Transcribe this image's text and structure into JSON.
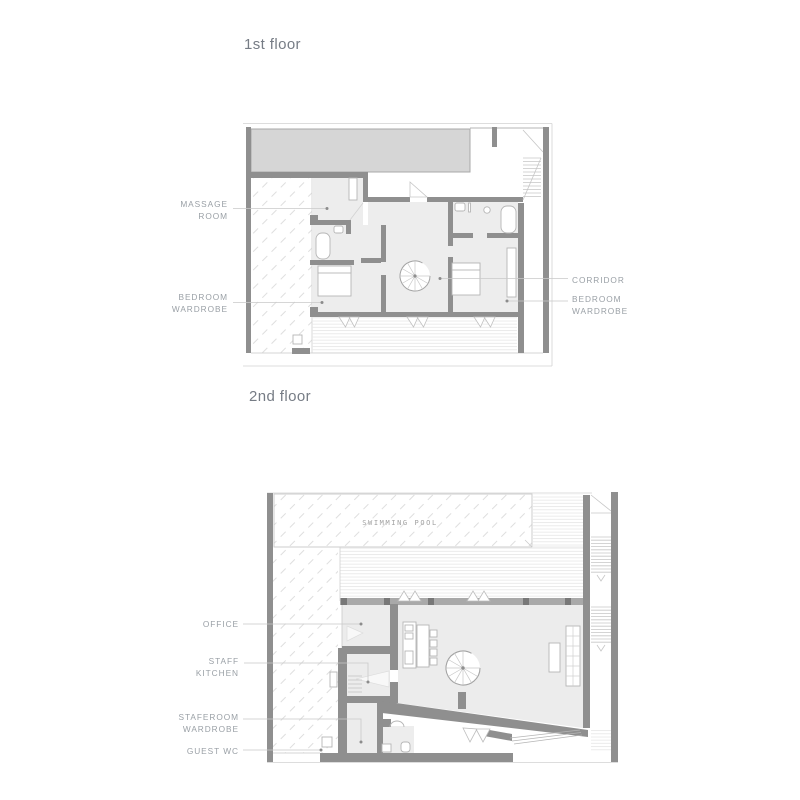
{
  "colors": {
    "wall": "#8f8f8f",
    "slab_fill": "#d6d6d6",
    "room_fill": "#ededed",
    "window_wall": "#a9a9a9",
    "hatch_line": "#dadada",
    "deck_line": "#e7e7e7",
    "leader_line": "#c9c9c9",
    "label_text": "#9aa0a6",
    "title_text": "#767c85"
  },
  "floor1": {
    "title": "1st floor",
    "labels": {
      "massage_room": {
        "line1": "MASSAGE",
        "line2": "ROOM"
      },
      "bedroom_wardrobe_left": {
        "line1": "BEDROOM",
        "line2": "WARDROBE"
      },
      "corridor": {
        "line1": "CORRIDOR"
      },
      "bedroom_wardrobe_right": {
        "line1": "BEDROOM",
        "line2": "WARDROBE"
      }
    }
  },
  "floor2": {
    "title": "2nd floor",
    "labels": {
      "office": {
        "line1": "OFFICE"
      },
      "staff_kitchen": {
        "line1": "STAFF",
        "line2": "KITCHEN"
      },
      "staferoom_wardrobe": {
        "line1": "STAFEROOM",
        "line2": "WARDROBE"
      },
      "guest_wc": {
        "line1": "GUEST WC"
      }
    },
    "plan_text": {
      "swimming_pool": "SWIMMING POOL"
    }
  }
}
